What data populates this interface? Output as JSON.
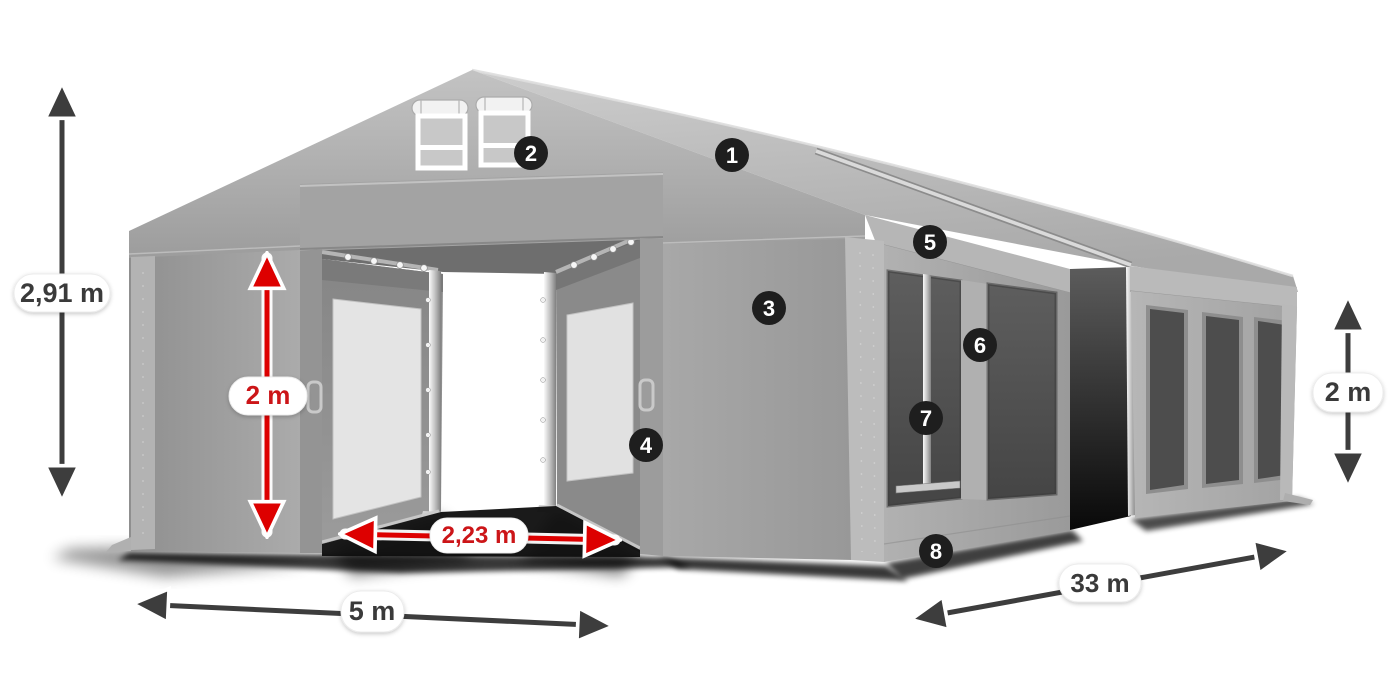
{
  "diagram": {
    "type": "tent-dimension-diagram",
    "subject": "storage-party-tent",
    "labels": {
      "total_height": "2,91 m",
      "entrance_height": "2 m",
      "entrance_width": "2,23 m",
      "front_width": "5 m",
      "side_length": "33 m",
      "side_height": "2 m"
    },
    "badges": [
      "1",
      "2",
      "3",
      "4",
      "5",
      "6",
      "7",
      "8"
    ],
    "colors": {
      "background": "#ffffff",
      "tent_gray": "#a6a6a6",
      "roof_light": "#c6c6c6",
      "mesh_dark": "#525252",
      "arrow_dark": "#3d3d3d",
      "arrow_red": "#dd0000",
      "label_text": "#3a3a3a",
      "label_text_red": "#cc1518",
      "badge_bg": "#1e1e1e",
      "badge_text": "#ffffff"
    }
  }
}
